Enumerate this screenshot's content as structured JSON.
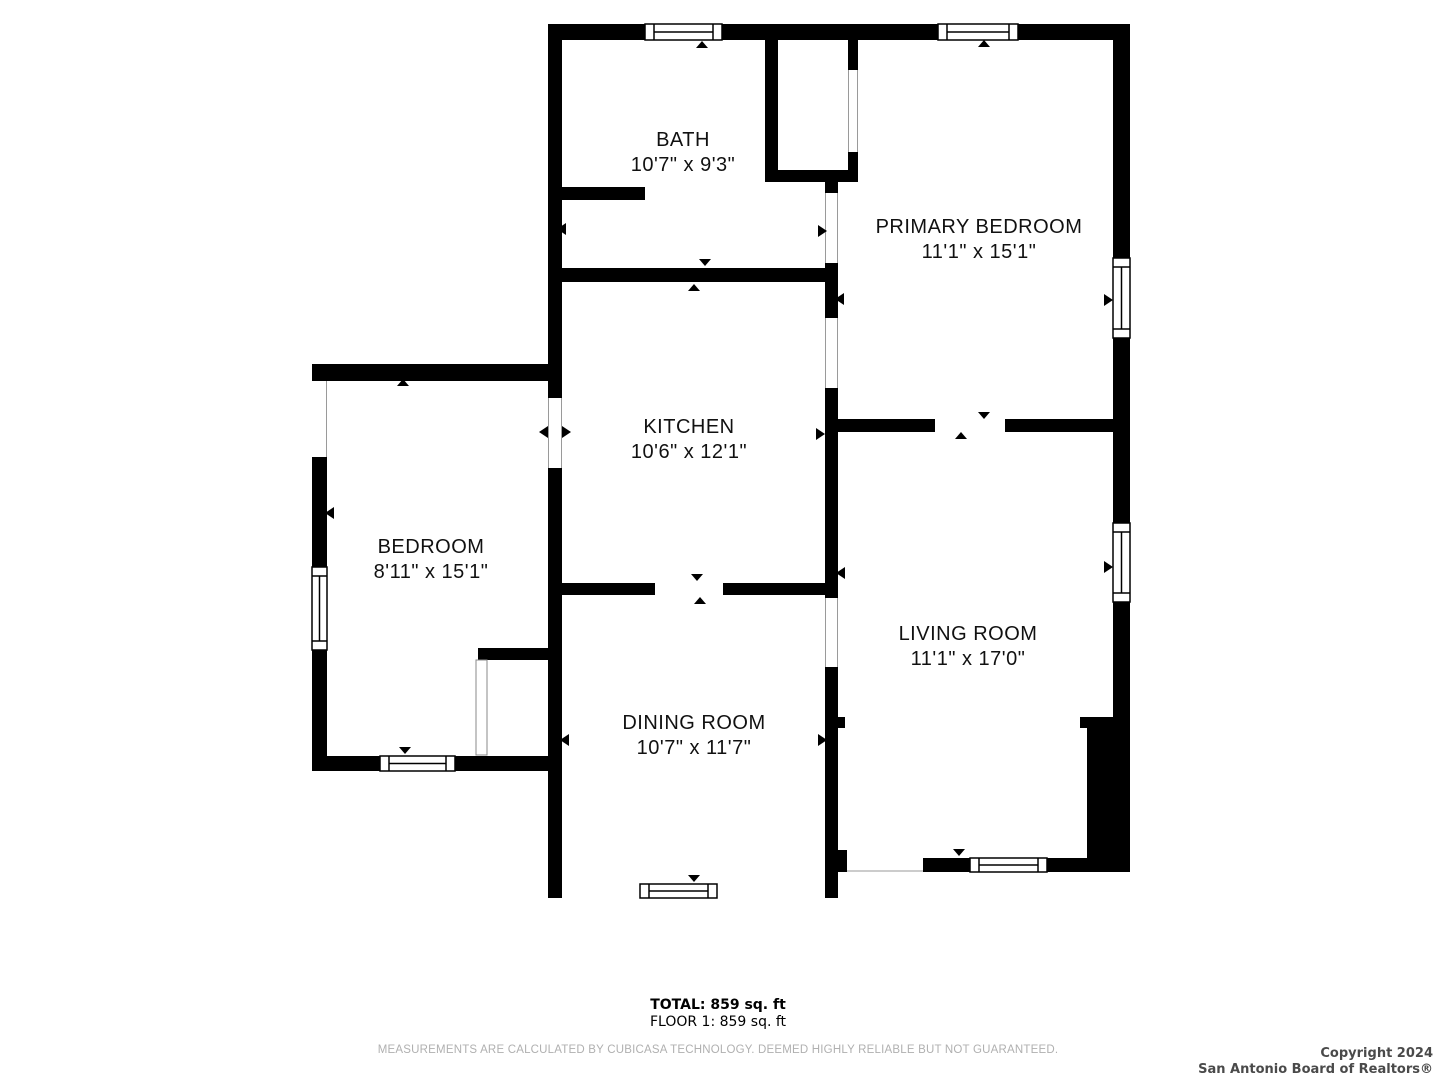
{
  "rooms": [
    {
      "name": "BATH",
      "dims": "10'7\" x 9'3\""
    },
    {
      "name": "PRIMARY BEDROOM",
      "dims": "11'1\" x 15'1\""
    },
    {
      "name": "KITCHEN",
      "dims": "10'6\" x 12'1\""
    },
    {
      "name": "BEDROOM",
      "dims": "8'11\" x 15'1\""
    },
    {
      "name": "LIVING ROOM",
      "dims": "11'1\" x 17'0\""
    },
    {
      "name": "DINING ROOM",
      "dims": "10'7\" x 11'7\""
    }
  ],
  "summary": {
    "total": "TOTAL: 859 sq. ft",
    "floor": "FLOOR 1: 859 sq. ft",
    "disclaimer": "MEASUREMENTS ARE CALCULATED BY CUBICASA TECHNOLOGY. DEEMED HIGHLY RELIABLE BUT NOT GUARANTEED."
  },
  "copyright": {
    "line1": "Copyright 2024",
    "line2": "San Antonio Board of Realtors®"
  },
  "colors": {
    "wall": "#000000",
    "background": "#ffffff",
    "label": "#111111",
    "disclaimer_text": "#b0b0b0",
    "copyright_text": "#4a4a4a"
  }
}
